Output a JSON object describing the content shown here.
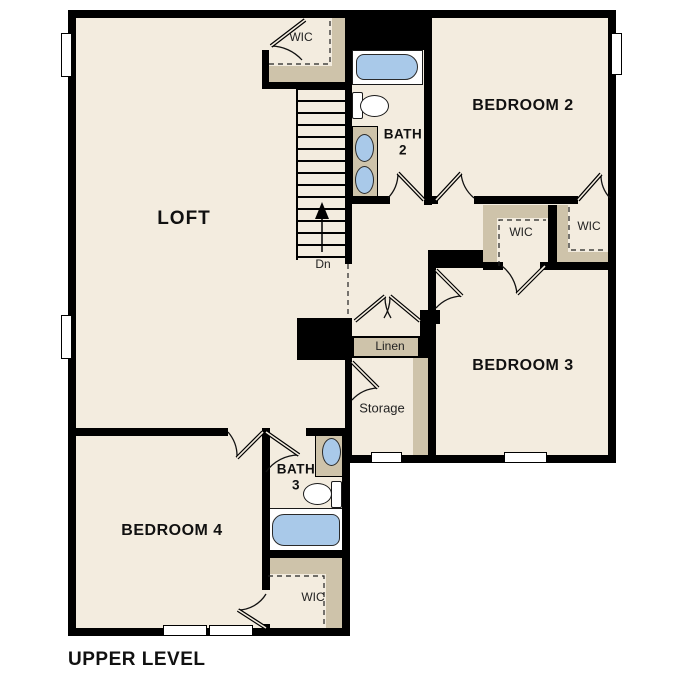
{
  "plan_title": "UPPER LEVEL",
  "rooms": {
    "loft": {
      "label": "LOFT"
    },
    "bedroom2": {
      "label": "BEDROOM 2"
    },
    "bedroom3": {
      "label": "BEDROOM 3"
    },
    "bedroom4": {
      "label": "BEDROOM 4"
    },
    "bath2": {
      "name": "BATH",
      "number": "2"
    },
    "bath3": {
      "name": "BATH",
      "number": "3"
    },
    "storage": {
      "label": "Storage"
    },
    "linen": {
      "label": "Linen"
    },
    "wic_top": {
      "label": "WIC"
    },
    "wic_bedroom2": {
      "label": "WIC"
    },
    "wic_bedroom3": {
      "label": "WIC"
    },
    "wic_bedroom4": {
      "label": "WIC"
    }
  },
  "stairs": {
    "direction_label": "Dn"
  },
  "colors": {
    "floor": "#f3ecdf",
    "wall": "#000000",
    "shelf": "#cec3aa",
    "fixture_blue": "#a9c9e9",
    "fixture_white": "#ffffff",
    "background": "#ffffff",
    "text": "#111111"
  }
}
